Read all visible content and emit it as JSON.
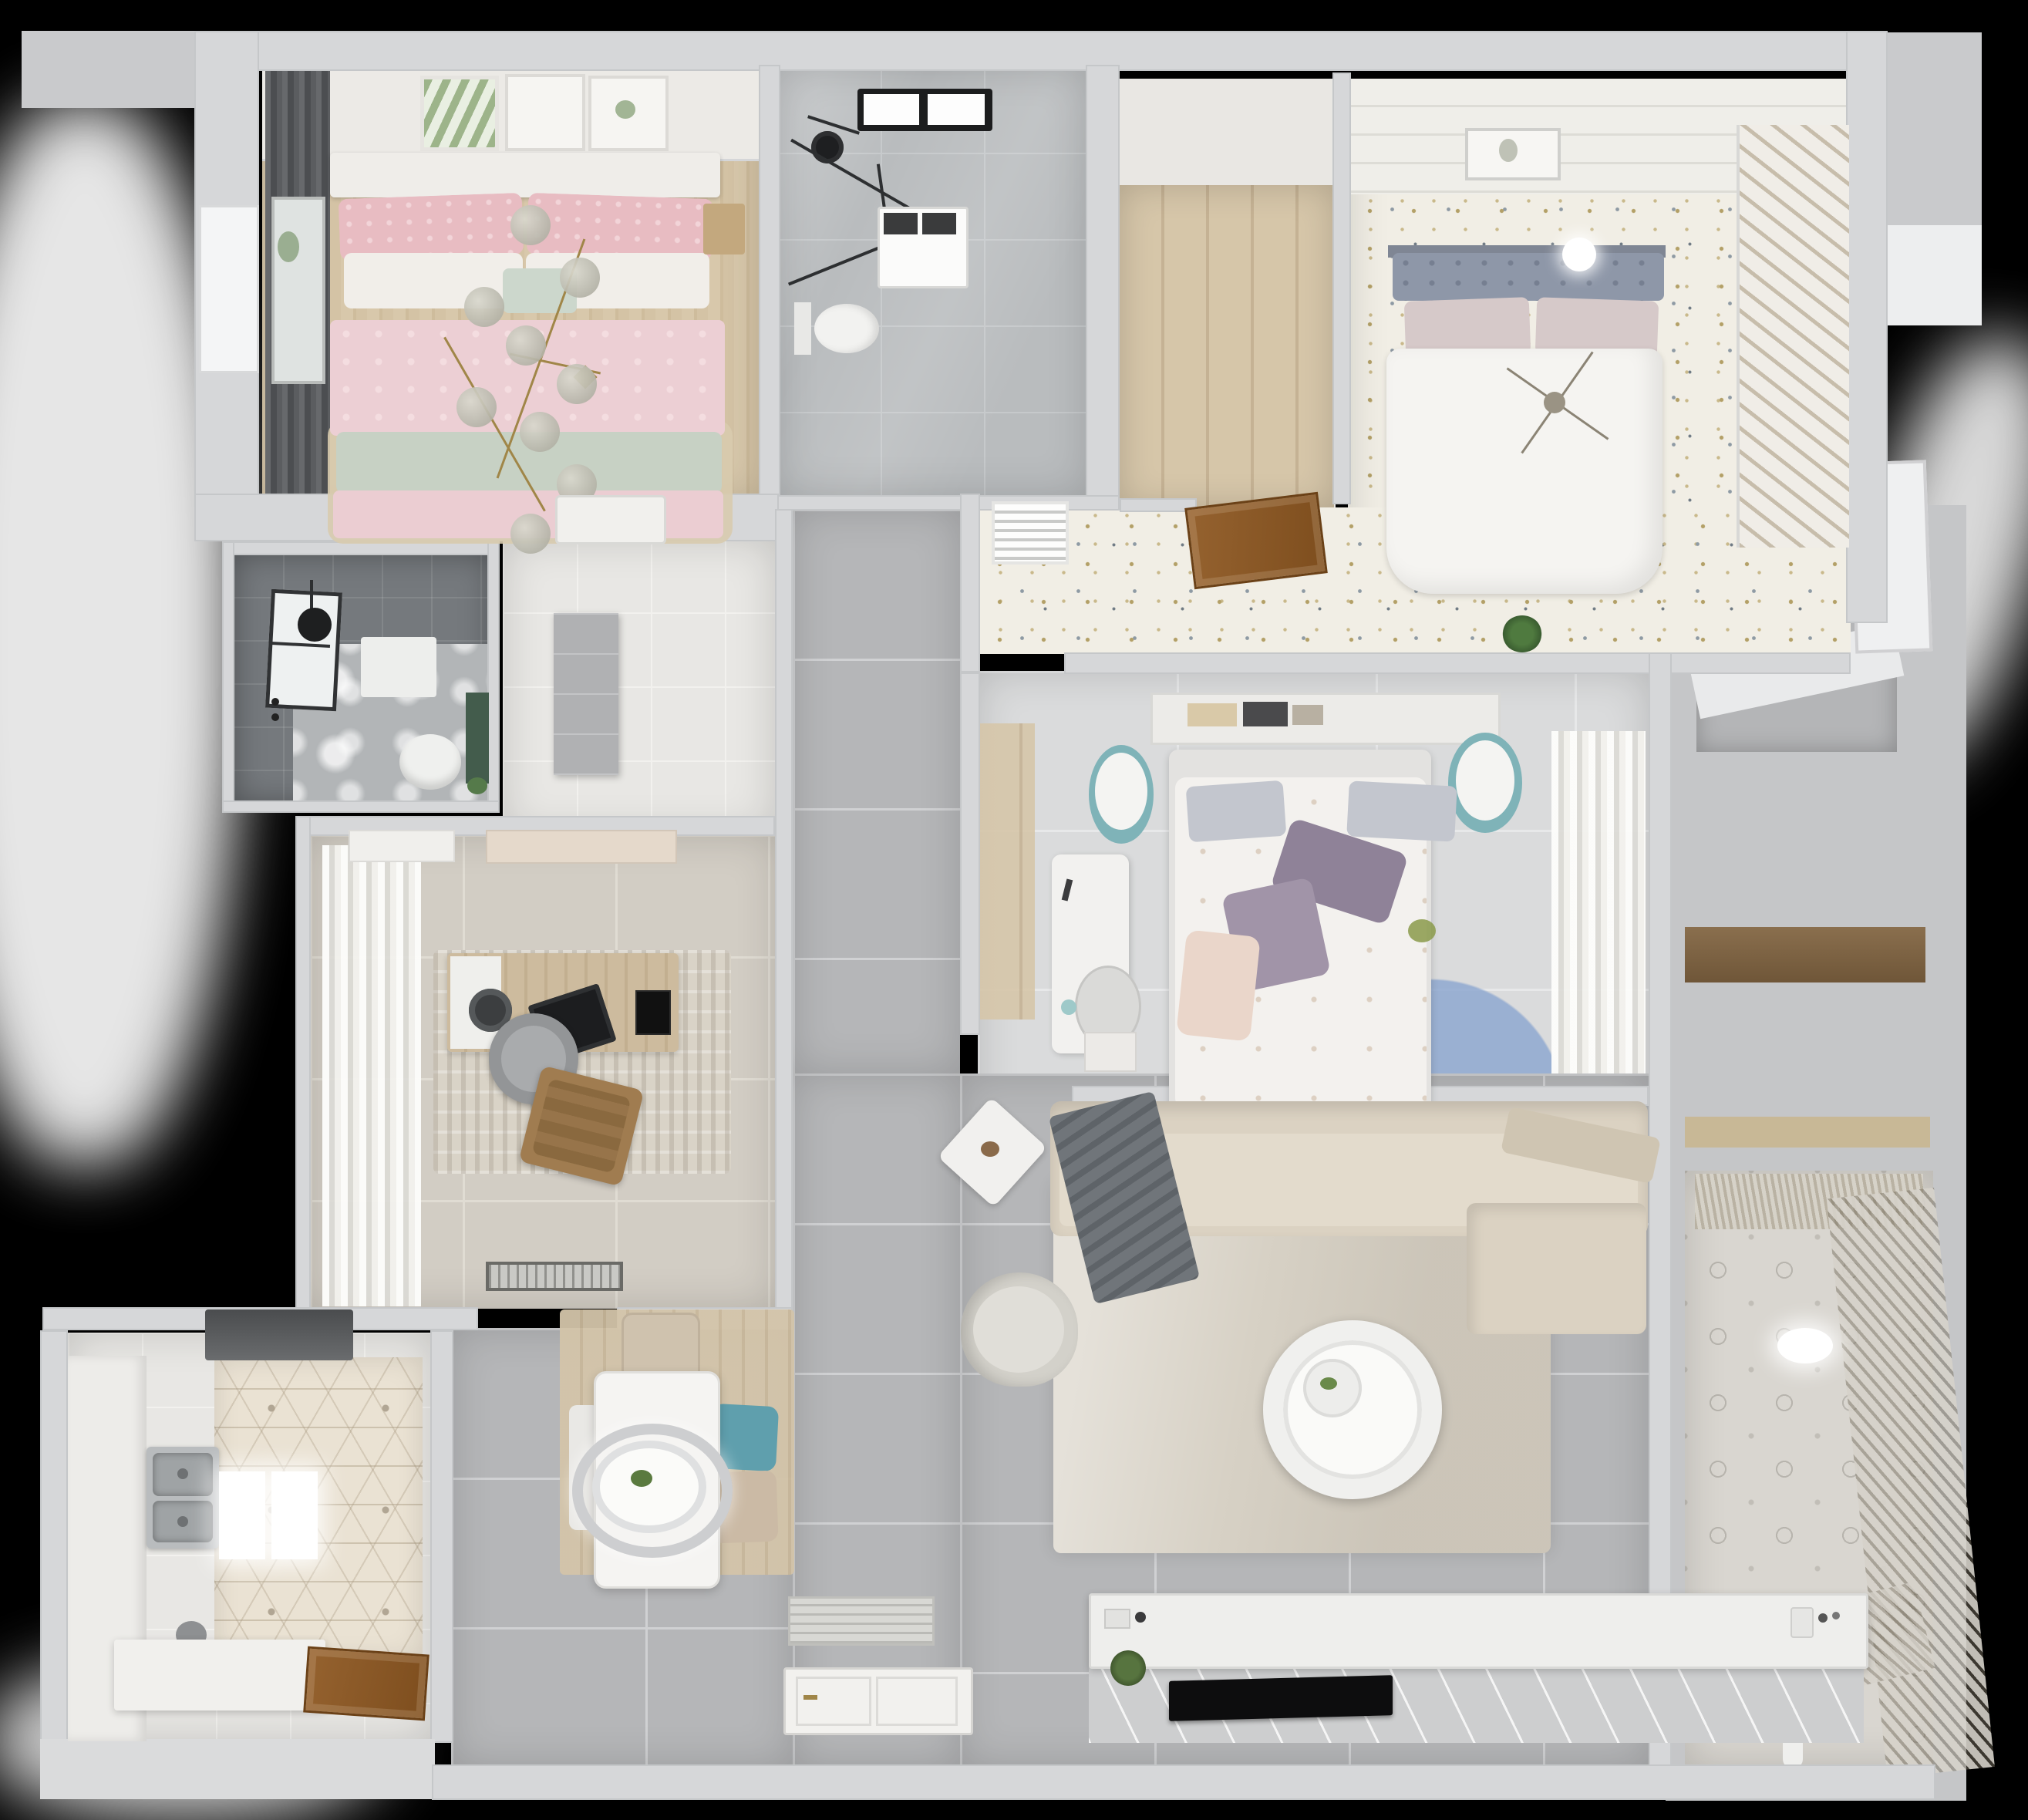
{
  "scene": {
    "type": "3d-rendered-apartment-floor-plan",
    "view": "top-down isometric render",
    "background": "#000000"
  },
  "palette": {
    "wall": "#d6d7d9",
    "gray_tile": "#b5b6b8",
    "wood_floor": "#d6c5a8",
    "door_wood": "#8d5a2d",
    "pink_bedding": "#eccfd4",
    "sage_blanket": "#c7d1c4",
    "white_duvet": "#f4f3f0",
    "teal_chair": "#5f9fad",
    "gold_fixture": "#a08648",
    "rug_blue": "#8aa5cf",
    "rug_mauve": "#b2909b",
    "rug_teal": "#9fb3b1",
    "hex_tile": "#eae2d3",
    "speckle_floor": "#f1eee5",
    "dark_bath": "#75797d"
  },
  "rooms": [
    {
      "id": "bedroom-pink",
      "label": "Bedroom with pink bed"
    },
    {
      "id": "bathroom-main",
      "label": "Main bathroom with shower"
    },
    {
      "id": "closet-room",
      "label": "Walk-in closet / utility room"
    },
    {
      "id": "bedroom-guest",
      "label": "Guest bedroom with white bed"
    },
    {
      "id": "bedroom-master",
      "label": "Master bedroom"
    },
    {
      "id": "hallway",
      "label": "Hallway"
    },
    {
      "id": "study",
      "label": "Study / home office"
    },
    {
      "id": "bathroom-dark",
      "label": "Shower bathroom"
    },
    {
      "id": "entry-hall",
      "label": "Entry hall"
    },
    {
      "id": "kitchen",
      "label": "Kitchen"
    },
    {
      "id": "dining",
      "label": "Dining area"
    },
    {
      "id": "living",
      "label": "Living room"
    },
    {
      "id": "balcony",
      "label": "Balcony / laundry"
    },
    {
      "id": "service",
      "label": "Service zone / stair landing"
    }
  ],
  "furniture": {
    "bed_pink": "Double bed with pink bedding",
    "gold_chandelier": "Gold branch chandelier",
    "bench": "Bedroom bench",
    "nightstand": "Wood nightstand",
    "wall_frames": "Picture frames",
    "skylight": "Bathroom window",
    "shower": "Rain shower head",
    "shower_glass": "Glass shower screen",
    "washer": "Washing machine",
    "toilet": "Toilet",
    "closet_door": "Open wood door",
    "bed_guest": "Double bed with white duvet",
    "tufted_headboard": "Tufted headboard",
    "wardrobe": "Slatted-door wardrobe",
    "ceiling_lamp": "Ceiling lamp",
    "vent": "Wall vent grille",
    "console_shelf": "Headboard shelf with books",
    "pouf": "Round bedside pouf",
    "bed_master": "Master bed with floral duvet",
    "desk_master": "Vanity desk",
    "circle_rug": "Overlapping circles rug",
    "sheer_curtains": "Sheer curtains",
    "sofa": "L-shaped sectional sofa",
    "throw_blanket": "Gray throw blanket",
    "living_rug": "Area rug",
    "coffee_table": "Round coffee table",
    "armchair": "Armchair",
    "side_table": "Side table with flowers",
    "tv_console": "TV console",
    "tv": "Wall-mounted TV",
    "dining_table": "Dining table",
    "pendant_lamp": "Oval pendant lamp",
    "dining_chair": "Dining chair",
    "dining_chair_teal": "Teal dining chair",
    "dining_rug": "Dining rug",
    "entry_mat": "Entry doormat",
    "entry_door": "Entry door (open)",
    "range_hood": "Range hood",
    "kitchen_sink": "Double-basin sink",
    "kitchen_counter": "Kitchen counter",
    "kitchen_island": "Kitchen worktop",
    "kitchen_window": "Kitchen window",
    "kitchen_door": "Open kitchen door",
    "ceiling_lights": "Ceiling light panels",
    "bath_window": "Bathroom window",
    "bath_mat": "Shower tray",
    "green_shelf": "Green storage shelf",
    "study_desk": "Writing desk",
    "laptop": "Laptop",
    "desk_chair": "Round desk chair",
    "lounge_chair": "Leather lounge chair",
    "study_rug": "Study rug",
    "study_curtains": "Curtains",
    "doormat": "Doormat",
    "hall_cabinet": "Hall cabinet",
    "white_door": "White interior door",
    "service_ledge": "Stair landing ledge",
    "closet_shelf": "Closet shelves",
    "balcony_blinds": "Louvered blinds",
    "balcony_light": "Ceiling light",
    "toys": "Toys on floor"
  }
}
